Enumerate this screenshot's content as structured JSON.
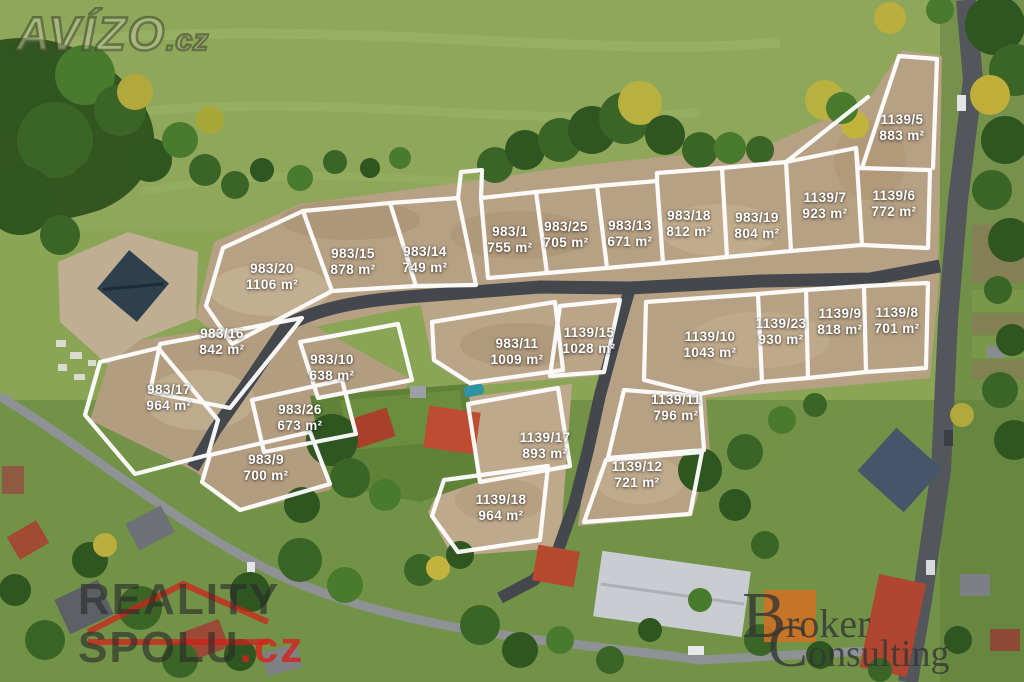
{
  "image_type": "aerial-photo-land-plots",
  "watermarks": {
    "avizo": {
      "text": "AVÍZO",
      "tld": ".cz"
    },
    "reality_spolu": {
      "line1": "REALITY",
      "line2": "SPOLU",
      "tld": ".cz"
    },
    "broker": {
      "line1_big": "B",
      "line1_rest": "roker",
      "line2_big": "C",
      "line2_rest": "onsulting"
    }
  },
  "colors": {
    "boundary_line": "#ffffff",
    "label_text": "#ffffff",
    "new_road": "#44484c",
    "dirt": "#b7a184",
    "field_green": "#8ba557",
    "reality_red": "#d6221c",
    "broker_orange": "#d17022"
  },
  "plots": [
    {
      "id": "983/20",
      "area": "1106 m²",
      "x": 272,
      "y": 277
    },
    {
      "id": "983/15",
      "area": "878 m²",
      "x": 353,
      "y": 262
    },
    {
      "id": "983/14",
      "area": "749 m²",
      "x": 425,
      "y": 260
    },
    {
      "id": "983/1",
      "area": "755 m²",
      "x": 510,
      "y": 240
    },
    {
      "id": "983/25",
      "area": "705 m²",
      "x": 566,
      "y": 235
    },
    {
      "id": "983/13",
      "area": "671 m²",
      "x": 630,
      "y": 234
    },
    {
      "id": "983/18",
      "area": "812 m²",
      "x": 689,
      "y": 224
    },
    {
      "id": "983/19",
      "area": "804 m²",
      "x": 757,
      "y": 226
    },
    {
      "id": "1139/7",
      "area": "923 m²",
      "x": 825,
      "y": 206
    },
    {
      "id": "1139/6",
      "area": "772 m²",
      "x": 894,
      "y": 204
    },
    {
      "id": "1139/5",
      "area": "883 m²",
      "x": 902,
      "y": 128
    },
    {
      "id": "983/16",
      "area": "842 m²",
      "x": 222,
      "y": 342
    },
    {
      "id": "983/17",
      "area": "964 m²",
      "x": 169,
      "y": 398
    },
    {
      "id": "983/10",
      "area": "638 m²",
      "x": 332,
      "y": 368
    },
    {
      "id": "983/26",
      "area": "673 m²",
      "x": 300,
      "y": 418
    },
    {
      "id": "983/9",
      "area": "700 m²",
      "x": 266,
      "y": 468
    },
    {
      "id": "983/11",
      "area": "1009 m²",
      "x": 517,
      "y": 352
    },
    {
      "id": "1139/15",
      "area": "1028 m²",
      "x": 589,
      "y": 341
    },
    {
      "id": "1139/10",
      "area": "1043 m²",
      "x": 710,
      "y": 345
    },
    {
      "id": "1139/23",
      "area": "930 m²",
      "x": 781,
      "y": 332
    },
    {
      "id": "1139/9",
      "area": "818 m²",
      "x": 840,
      "y": 322
    },
    {
      "id": "1139/8",
      "area": "701 m²",
      "x": 897,
      "y": 321
    },
    {
      "id": "1139/11",
      "area": "796 m²",
      "x": 676,
      "y": 408
    },
    {
      "id": "1139/17",
      "area": "893 m²",
      "x": 545,
      "y": 446
    },
    {
      "id": "1139/12",
      "area": "721 m²",
      "x": 637,
      "y": 475
    },
    {
      "id": "1139/18",
      "area": "964 m²",
      "x": 501,
      "y": 508
    }
  ]
}
